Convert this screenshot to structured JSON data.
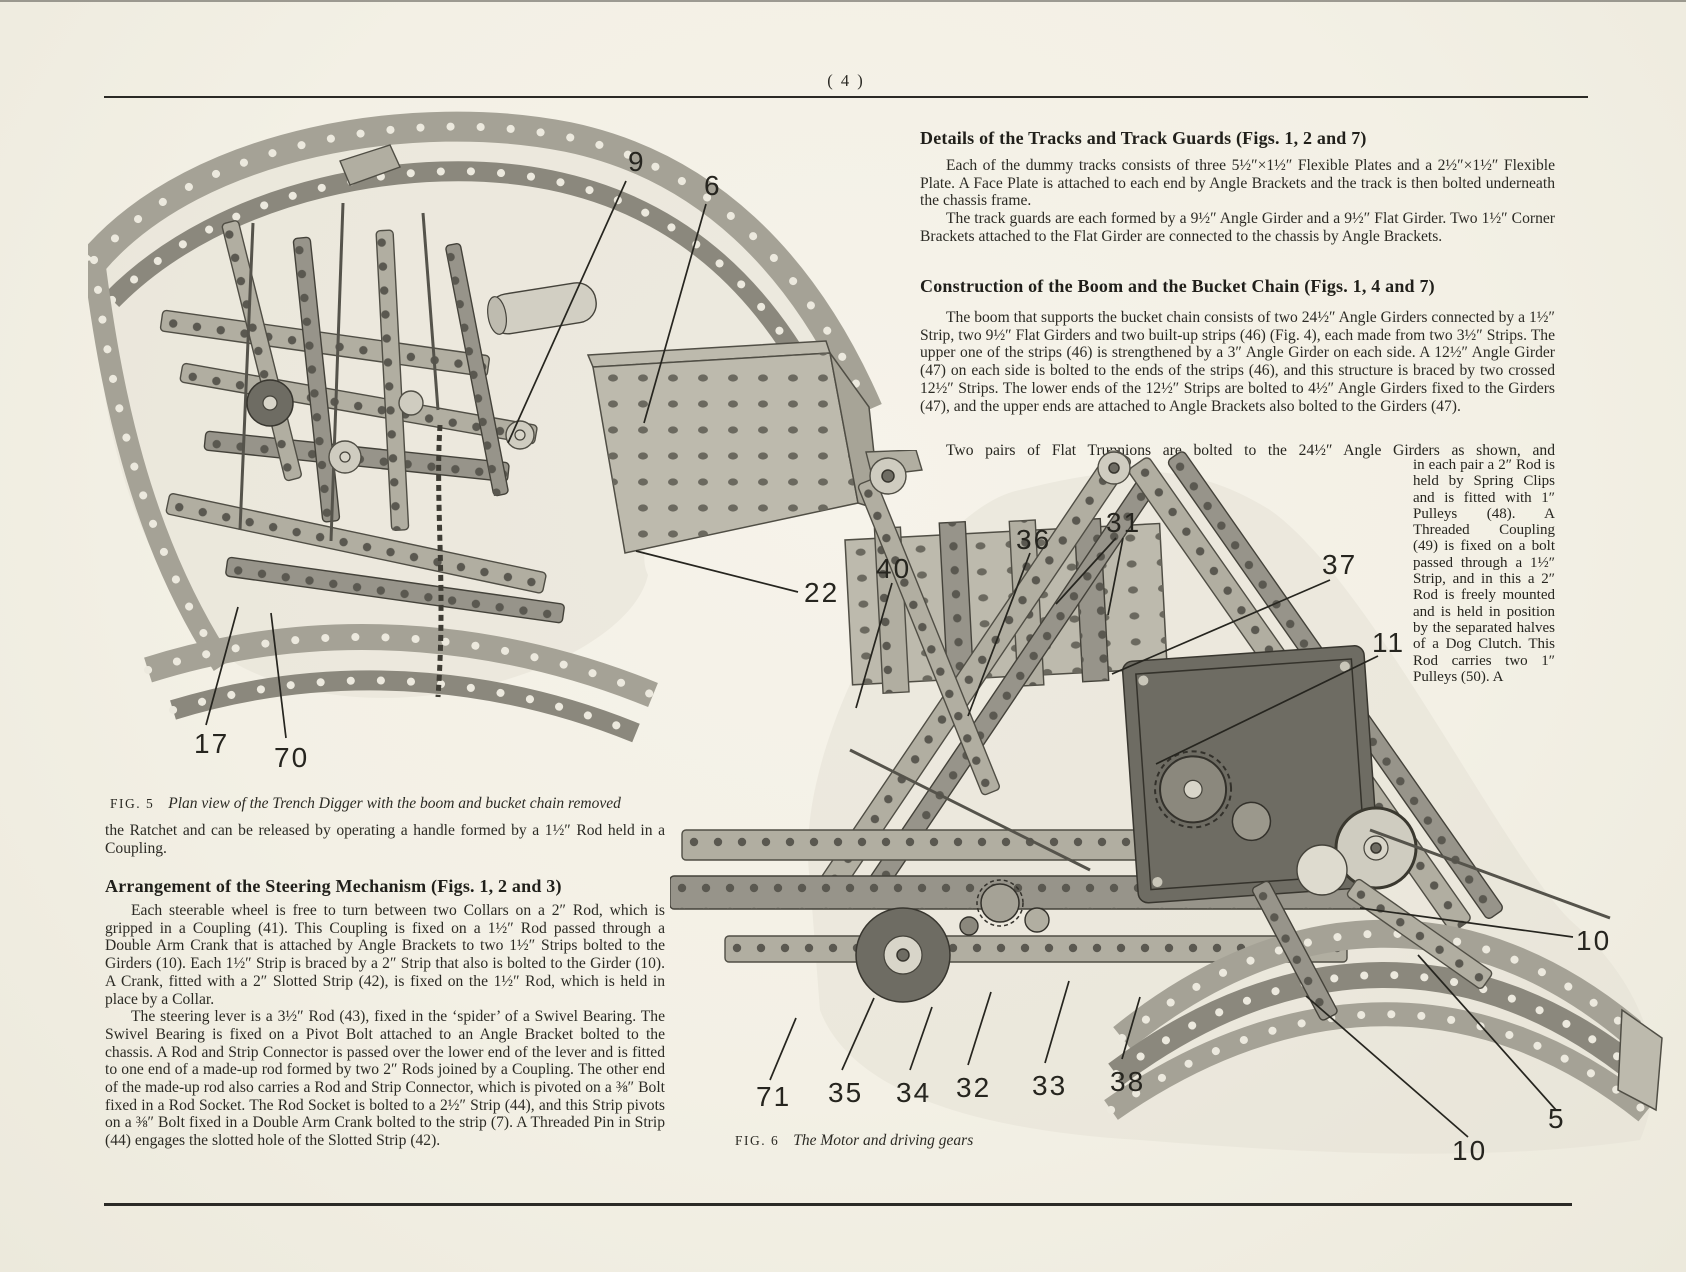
{
  "page": {
    "number": "( 4 )"
  },
  "sections": {
    "tracks": {
      "heading": "Details of the Tracks and Track Guards (Figs. 1, 2 and 7)",
      "para1": "Each of the dummy tracks consists of three 5½″×1½″ Flexible Plates and a 2½″×1½″ Flexible Plate. A Face Plate is attached to each end by Angle Brackets and the track is then bolted underneath the chassis frame.",
      "para2": "The track guards are each formed by a 9½″ Angle Girder and a 9½″ Flat Girder. Two 1½″ Corner Brackets attached to the Flat Girder are connected to the chassis by Angle Brackets."
    },
    "boom": {
      "heading": "Construction of the Boom and the Bucket Chain (Figs. 1, 4 and 7)",
      "para1": "The boom that supports the bucket chain consists of two 24½″ Angle Girders connected by a 1½″ Strip, two 9½″ Flat Girders and two built-up strips (46) (Fig. 4), each made from two 3½″ Strips. The upper one of the strips (46) is strengthened by a 3″ Angle Girder on each side. A 12½″ Angle Girder (47) on each side is bolted to the ends of the strips (46), and this structure is braced by two crossed 12½″ Strips. The lower ends of the 12½″ Strips are bolted to 4½″ Angle Girders fixed to the Girders (47), and the upper ends are attached to Angle Brackets also bolted to the Girders (47).",
      "para2_lead": "Two pairs of Flat Trunnions are bolted to the 24½″ Angle Girders as shown, and",
      "para2_wrap": "in each pair a 2″ Rod is held by Spring Clips and is fitted with 1″ Pulleys (48). A Threaded Coupling (49) is fixed on a bolt passed through a 1½″ Strip, and in this a 2″ Rod is freely mounted and is held in position by the separated halves of a Dog Clutch. This Rod carries two 1″ Pulleys (50). A"
    },
    "ratchet_continuation": "the Ratchet and can be released by operating a handle formed by a 1½″ Rod held in a Coupling.",
    "steering": {
      "heading": "Arrangement of the Steering Mechanism (Figs. 1, 2 and 3)",
      "para1": "Each steerable wheel is free to turn between two Collars on a 2″ Rod, which is gripped in a Coupling (41). This Coupling is fixed on a 1½″ Rod passed through a Double Arm Crank that is attached by Angle Brackets to two 1½″ Strips bolted to the Girders (10). Each 1½″ Strip is braced by a 2″ Strip that also is bolted to the Girder (10). A Crank, fitted with a 2″ Slotted Strip (42), is fixed on the 1½″ Rod, which is held in place by a Collar.",
      "para2": "The steering lever is a 3½″ Rod (43), fixed in the ‘spider’ of a Swivel Bearing. The Swivel Bearing is fixed on a Pivot Bolt attached to an Angle Bracket bolted to the chassis. A Rod and Strip Connector is passed over the lower end of the lever and is fitted to one end of a made-up rod formed by two 2″ Rods joined by a Coupling. The other end of the made-up rod also carries a Rod and Strip Connector, which is pivoted on a ⅜″ Bolt fixed in a Rod Socket. The Rod Socket is bolted to a 2½″ Strip (44), and this Strip pivots on a ⅜″ Bolt fixed in a Double Arm Crank bolted to the strip (7). A Threaded Pin in Strip (44) engages the slotted hole of the Slotted Strip (42)."
    }
  },
  "fig5": {
    "label": "FIG. 5",
    "caption": "Plan view of the Trench Digger with the boom and bucket chain removed",
    "callouts": [
      "9",
      "6",
      "22",
      "17",
      "70"
    ]
  },
  "fig6": {
    "label": "FIG. 6",
    "caption": "The Motor and driving gears",
    "callouts": [
      "40",
      "36",
      "31",
      "37",
      "11",
      "10",
      "5",
      "10",
      "71",
      "35",
      "34",
      "32",
      "33",
      "38"
    ]
  }
}
